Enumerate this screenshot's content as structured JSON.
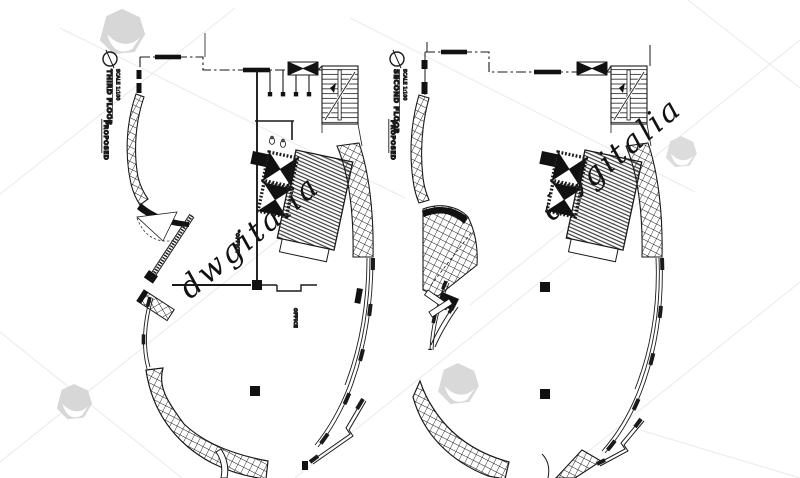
{
  "watermark": {
    "text": "dwgitalia",
    "text_color": "#dedede",
    "logo_color": "#d7d7d7",
    "grid_line_color": "#ebebeb"
  },
  "drawing": {
    "ink_color": "#1a1a1a",
    "background_color": "#ffffff"
  },
  "plans": [
    {
      "id": "third-floor",
      "title": "THIRD FLOOR",
      "scale_label": "SCALE 1:100",
      "status_label": "PROPOSED",
      "room_labels": [
        "OFFICE",
        "OFFICE"
      ]
    },
    {
      "id": "second-floor",
      "title": "SECOND FLOOR",
      "scale_label": "SCALE 1:100",
      "status_label": "PROPOSED",
      "room_labels": []
    }
  ]
}
